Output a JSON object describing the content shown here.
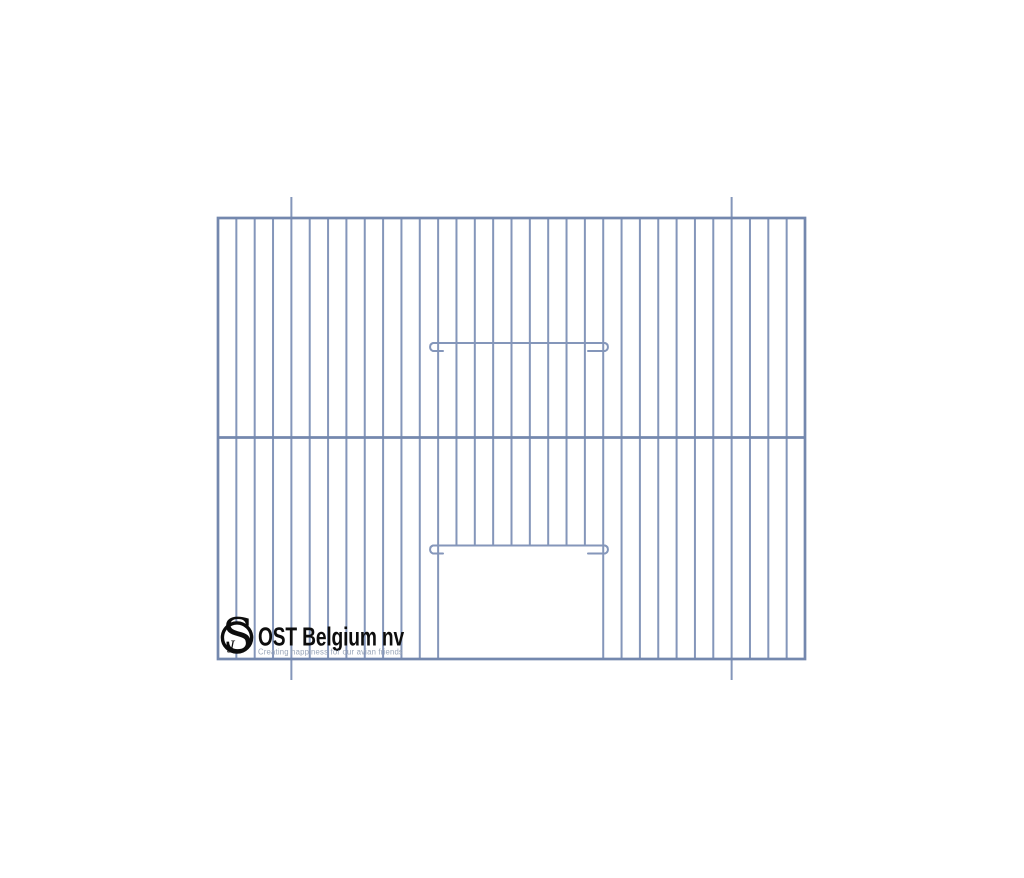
{
  "page": {
    "background_color": "#ffffff"
  },
  "diagram": {
    "description": "cage-front-panel-wire-drawing",
    "canvas": {
      "width": 1024,
      "height": 878
    },
    "wire": {
      "bar_color": "#8496ba",
      "frame_color": "#7488ae",
      "bar_width": 2,
      "frame_width": 2.7
    },
    "frame": {
      "left": 218,
      "top": 218,
      "right": 805,
      "bottom": 659
    },
    "bars": {
      "intervals": 32
    },
    "middle_rail_y": 437.5,
    "door": {
      "left_bar": 12,
      "right_bar": 21,
      "top_y": 545.5
    },
    "anchor_pins": {
      "bar_indices": [
        4,
        28
      ],
      "extension": 21
    },
    "hook_wires": [
      {
        "y": 343,
        "x_start": 433,
        "x_end": 605,
        "drop": 8,
        "stub_left": 10,
        "stub_right": 17,
        "radius": 4.2
      },
      {
        "y": 545.5,
        "x_start": 433,
        "x_end": 605,
        "drop": 8,
        "stub_left": 10,
        "stub_right": 17,
        "radius": 4.2
      }
    ]
  },
  "logo": {
    "monogram": "S",
    "monogram_accent": "J",
    "company_name": "OST Belgium nv",
    "tagline": "Creating happiness for our avian friends",
    "ink_color": "#0d0d0d",
    "tagline_color": "#98a5b8",
    "ring": {
      "cx": 237,
      "cy": 637.5,
      "r": 14.6,
      "stroke_width": 3.4
    }
  }
}
